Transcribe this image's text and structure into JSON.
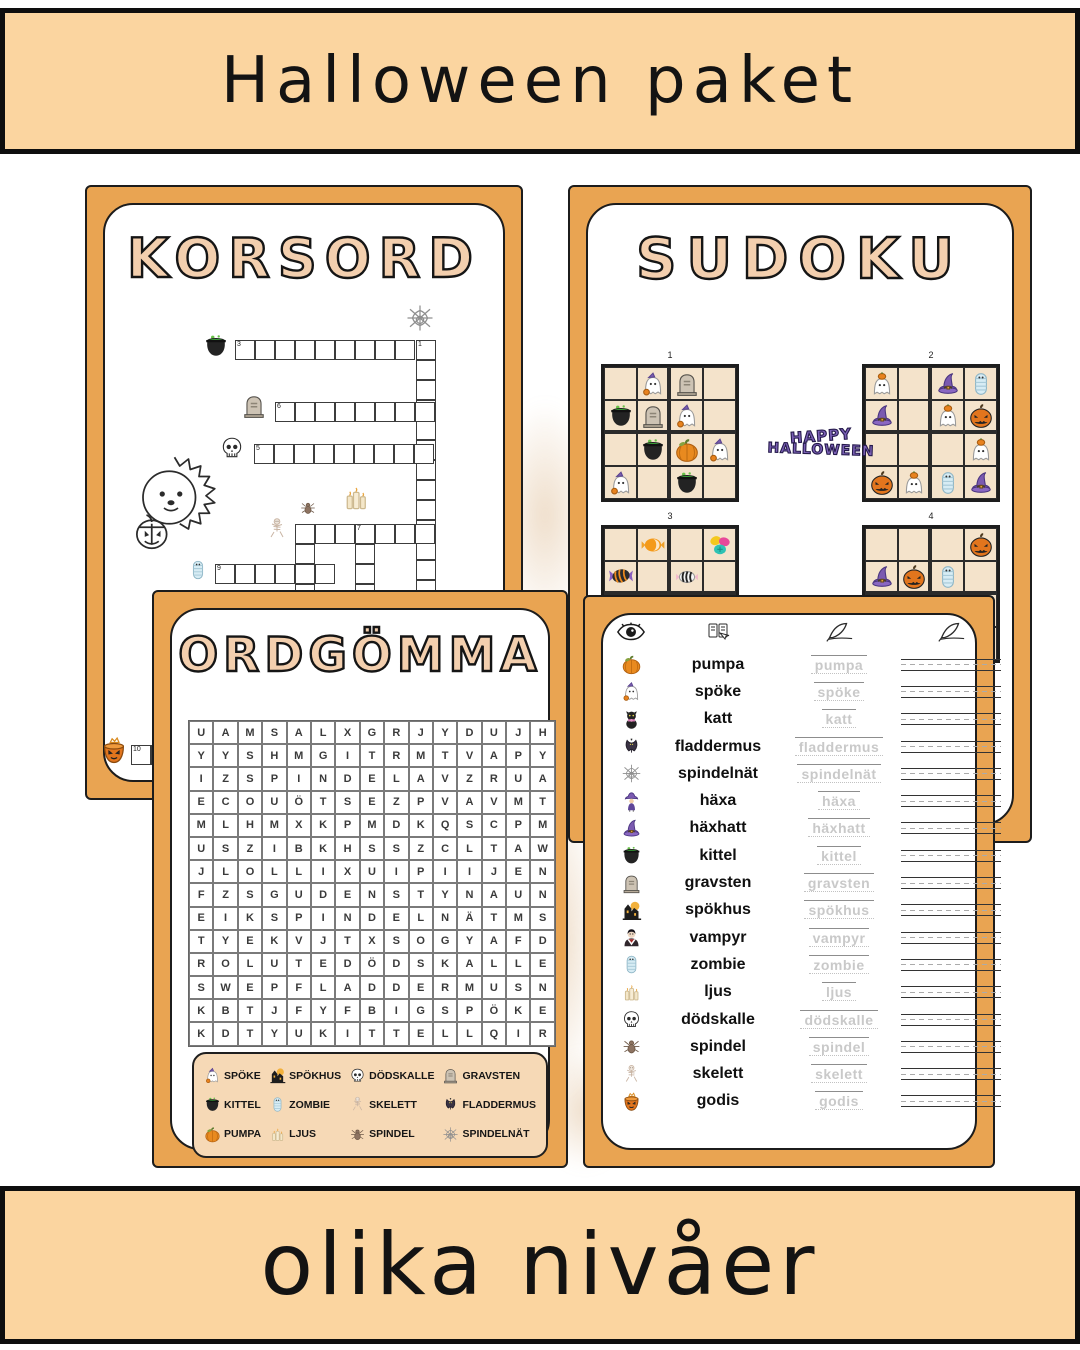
{
  "banner_top": {
    "title": "Halloween paket"
  },
  "banner_bottom": {
    "title": "olika nivåer",
    "icon": "mug"
  },
  "korsord": {
    "title": "KORSORD",
    "entries": [
      {
        "num": "3",
        "x": 148,
        "y": 153,
        "len": 9,
        "dir": "h"
      },
      {
        "num": "1",
        "x": 329,
        "y": 153,
        "len": 13,
        "dir": "v"
      },
      {
        "num": "6",
        "x": 188,
        "y": 215,
        "len": 8,
        "dir": "h"
      },
      {
        "num": "5",
        "x": 167,
        "y": 257,
        "len": 9,
        "dir": "h"
      },
      {
        "num": "2",
        "x": 208,
        "y": 337,
        "len": 7,
        "dir": "h"
      },
      {
        "num": "",
        "x": 208,
        "y": 337,
        "len": 5,
        "dir": "v"
      },
      {
        "num": "7",
        "x": 268,
        "y": 337,
        "len": 5,
        "dir": "v"
      },
      {
        "num": "9",
        "x": 128,
        "y": 377,
        "len": 6,
        "dir": "h"
      },
      {
        "num": "10",
        "x": 44,
        "y": 558,
        "len": 8,
        "dir": "h"
      }
    ],
    "icons": [
      {
        "name": "cauldron",
        "x": 116,
        "y": 146,
        "s": 26
      },
      {
        "name": "web",
        "x": 318,
        "y": 116,
        "s": 30
      },
      {
        "name": "gravestone",
        "x": 154,
        "y": 206,
        "s": 26
      },
      {
        "name": "skull",
        "x": 132,
        "y": 248,
        "s": 26
      },
      {
        "name": "spider",
        "x": 212,
        "y": 312,
        "s": 18
      },
      {
        "name": "candles",
        "x": 254,
        "y": 296,
        "s": 30
      },
      {
        "name": "skeleton",
        "x": 178,
        "y": 330,
        "s": 24
      },
      {
        "name": "mummy",
        "x": 100,
        "y": 372,
        "s": 22
      },
      {
        "name": "candy-bucket",
        "x": 12,
        "y": 548,
        "s": 30
      }
    ]
  },
  "sudoku": {
    "title": "SUDOKU",
    "logo": {
      "line1": "HAPPY",
      "line2": "HALLOWEEN"
    },
    "grids": [
      {
        "label": "1",
        "x": 31,
        "y": 177,
        "cells": [
          "",
          "ghost-hat",
          "gravestone",
          "",
          "cauldron",
          "gravestone",
          "ghost-hat",
          "",
          "",
          "cauldron",
          "pumpkin",
          "ghost-hat",
          "ghost-hat",
          "",
          "cauldron",
          ""
        ]
      },
      {
        "label": "2",
        "x": 292,
        "y": 177,
        "cells": [
          "ghost-pumpkin",
          "",
          "witch-hat",
          "mummy",
          "witch-hat",
          "",
          "ghost-pumpkin",
          "jack-o-lantern",
          "",
          "",
          "",
          "ghost-pumpkin",
          "jack-o-lantern",
          "ghost-pumpkin",
          "mummy",
          "witch-hat"
        ]
      },
      {
        "label": "3",
        "x": 31,
        "y": 338,
        "cells": [
          "",
          "candy-orange",
          "",
          "candy-pile",
          "candy-wrap",
          "",
          "candy-stripe",
          "",
          "",
          "",
          "",
          "",
          "",
          "",
          "",
          ""
        ]
      },
      {
        "label": "4",
        "x": 292,
        "y": 338,
        "cells": [
          "",
          "",
          "",
          "jack-o-lantern",
          "witch-hat",
          "jack-o-lantern",
          "mummy",
          "",
          "",
          "",
          "",
          "",
          "",
          "",
          "",
          ""
        ]
      }
    ]
  },
  "ordgomma": {
    "title": "ORDGÖMMA",
    "grid_rows": [
      "UAMSALXGRJYDUJH",
      "YYSHMGITRMTVAPY",
      "IZSPINDELAVZRUA",
      "ECOUÖTSEZPVAVMT",
      "MLHMXKPMDKQSCPM",
      "USZIBKHSSZCLTAW",
      "JLOLLIXUIPIIJEN",
      "FZSGUDENSTYNAUN",
      "EIKSPINDELNÄTMS",
      "TYEKVJTXSOGYAFD",
      "ROLUTEDÖDSKALLE",
      "SWEPFLADDERMUSN",
      "KBTJFYFBIGSPÖKE",
      "KDTYUKITTELLQIR"
    ],
    "words": [
      {
        "icon": "ghost-hat",
        "label": "SPÖKE"
      },
      {
        "icon": "haunted-house",
        "label": "SPÖKHUS"
      },
      {
        "icon": "skull",
        "label": "DÖDSKALLE"
      },
      {
        "icon": "gravestone",
        "label": "GRAVSTEN"
      },
      {
        "icon": "cauldron",
        "label": "KITTEL"
      },
      {
        "icon": "mummy",
        "label": "ZOMBIE"
      },
      {
        "icon": "skeleton",
        "label": "SKELETT"
      },
      {
        "icon": "bat",
        "label": "FLADDERMUS"
      },
      {
        "icon": "pumpkin",
        "label": "PUMPA"
      },
      {
        "icon": "candles",
        "label": "LJUS"
      },
      {
        "icon": "spider",
        "label": "SPINDEL"
      },
      {
        "icon": "web",
        "label": "SPINDELNÄT"
      }
    ]
  },
  "tracing": {
    "header_icons": [
      "eye",
      "read",
      "quill",
      "quill"
    ],
    "rows": [
      {
        "icon": "pumpkin",
        "word": "pumpa"
      },
      {
        "icon": "ghost-hat",
        "word": "spöke"
      },
      {
        "icon": "cat",
        "word": "katt"
      },
      {
        "icon": "bat",
        "word": "fladdermus"
      },
      {
        "icon": "web",
        "word": "spindelnät"
      },
      {
        "icon": "witch",
        "word": "häxa"
      },
      {
        "icon": "witch-hat",
        "word": "häxhatt"
      },
      {
        "icon": "cauldron",
        "word": "kittel"
      },
      {
        "icon": "gravestone",
        "word": "gravsten"
      },
      {
        "icon": "haunted-house",
        "word": "spökhus"
      },
      {
        "icon": "vampire",
        "word": "vampyr"
      },
      {
        "icon": "mummy",
        "word": "zombie"
      },
      {
        "icon": "candles",
        "word": "ljus"
      },
      {
        "icon": "skull",
        "word": "dödskalle"
      },
      {
        "icon": "spider",
        "word": "spindel"
      },
      {
        "icon": "skeleton",
        "word": "skelett"
      },
      {
        "icon": "candy-bucket",
        "word": "godis"
      }
    ]
  },
  "colors": {
    "banner": "#fbd5a0",
    "page_orange": "#e9a452",
    "sudoku_cell": "#f4e3cb",
    "title_fill": "#f3cfae",
    "wordbox": "#f6d9b6",
    "logo_purple": "#7a5fb5"
  }
}
